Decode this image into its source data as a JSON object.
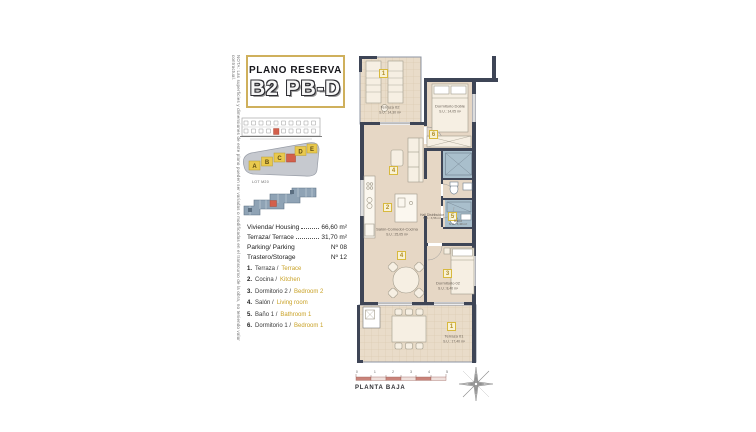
{
  "header": {
    "kicker": "PLANO RESERVA",
    "title": "B2 PB-D"
  },
  "disclaimer": "NOTA: Las superficies y dimensiones de este plano pueden ser variadas o modificadas en el transcurso de la obra, no teniendo valor contractual.",
  "site": {
    "lot_label": "LOT M20",
    "blocks": [
      "A",
      "B",
      "C",
      "D",
      "E"
    ]
  },
  "specs": {
    "rows": [
      {
        "label": "Vivienda/ Housing",
        "value": "66,60 m²"
      },
      {
        "label": "Terraza/ Terrace",
        "value": "31,70 m²"
      },
      {
        "label": "Parking/ Parking",
        "value": "Nº 08"
      },
      {
        "label": "Trastero/Storage",
        "value": "Nº 12"
      }
    ]
  },
  "legend": {
    "items": [
      {
        "num": "1.",
        "es": "Terraza /",
        "en": "Terrace"
      },
      {
        "num": "2.",
        "es": "Cocina /",
        "en": "Kitchen"
      },
      {
        "num": "3.",
        "es": "Dormitorio 2 /",
        "en": "Bedroom 2"
      },
      {
        "num": "4.",
        "es": "Salón /",
        "en": "Living room"
      },
      {
        "num": "5.",
        "es": "Baño 1 /",
        "en": "Bathroom 1"
      },
      {
        "num": "6.",
        "es": "Dormitorio 1 /",
        "en": "Bedroom 1"
      }
    ]
  },
  "plan": {
    "rooms": [
      {
        "name": "Terraza 02",
        "area": "S.U.: 14,30 m²"
      },
      {
        "name": "Dormitorio Doble",
        "area": "S.U.: 14,05 m²"
      },
      {
        "name": "Salón-Comedor-Cocina",
        "area": "S.U.: 25,05 m²"
      },
      {
        "name": "Hall Distribuidor",
        "area": "S.U.: 3,56 m²"
      },
      {
        "name": "Baño",
        "area": "S.U.: 3,40 m²"
      },
      {
        "name": "Dormitorio 02",
        "area": "S.U.: 8,40 m²"
      },
      {
        "name": "Terraza 01",
        "area": "S.U.: 17,40 m²"
      }
    ],
    "badges": {
      "terraza2": "1",
      "dormitorio1": "6",
      "salon": "4",
      "cocina": "2",
      "bano": "5",
      "comedor": "4",
      "dormitorio2": "3",
      "terraza1": "1"
    }
  },
  "footer": {
    "caption": "PLANTA BAJA",
    "scale_numbers": [
      "0",
      "1",
      "2",
      "3",
      "4",
      "5"
    ]
  },
  "colors": {
    "accent_gold": "#c9a227",
    "wall": "#3e4556",
    "floor": "#e6d7c5",
    "bath": "#a9bfcc",
    "highlight_red": "#d35f4b",
    "scale_pink": "#c9837a"
  }
}
